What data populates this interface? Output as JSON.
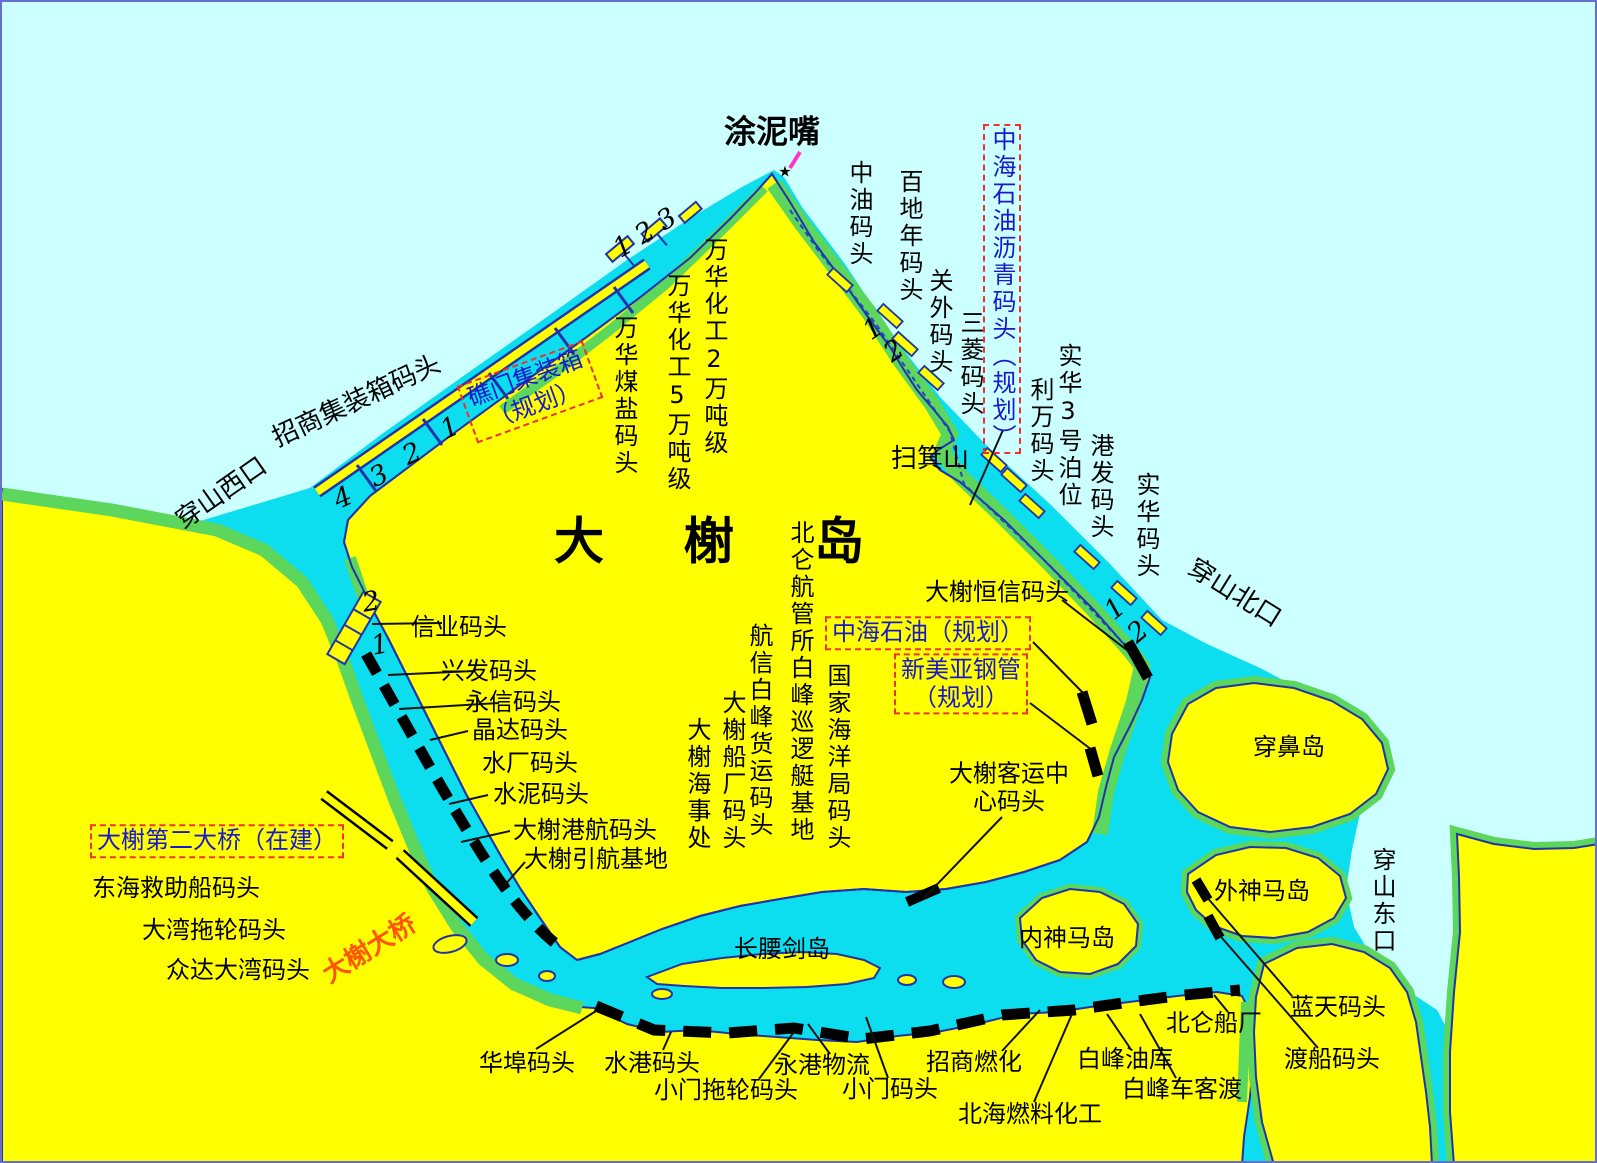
{
  "map": {
    "title": "大榭岛",
    "colors": {
      "sea_far": "#CCFFFF",
      "sea_channel": "#0CDEF0",
      "land": "#FFFF00",
      "coastal_green": "#5CD65C",
      "coast_outline": "#2233AA",
      "berth": "#000000",
      "planned_text": "#1818CC",
      "planned_box": "#F03030",
      "bridge_red_label": "#FF5500",
      "marker": "#FF33CC",
      "frame": "#6670CC"
    },
    "labels": [
      {
        "n": "tunizui",
        "t": "涂泥嘴",
        "x": 770,
        "y": 130,
        "c": "big"
      },
      {
        "n": "tunizui-star",
        "t": "★",
        "x": 783,
        "y": 170,
        "s": 15
      },
      {
        "n": "saojishan",
        "t": "扫箕山",
        "x": 928,
        "y": 458,
        "c": "mid"
      },
      {
        "n": "daxie-title",
        "t": "大榭岛",
        "x": 552,
        "y": 540,
        "c": "title"
      },
      {
        "n": "hengxin",
        "t": "大榭恒信码头",
        "x": 995,
        "y": 591
      },
      {
        "n": "xinye",
        "t": "信业码头",
        "x": 457,
        "y": 626
      },
      {
        "n": "xingfa",
        "t": "兴发码头",
        "x": 487,
        "y": 670
      },
      {
        "n": "yongxin",
        "t": "永信码头",
        "x": 511,
        "y": 701
      },
      {
        "n": "jingda",
        "t": "晶达码头",
        "x": 518,
        "y": 729
      },
      {
        "n": "shuichang",
        "t": "水厂码头",
        "x": 528,
        "y": 762
      },
      {
        "n": "shuini",
        "t": "水泥码头",
        "x": 539,
        "y": 793
      },
      {
        "n": "ganghang",
        "t": "大榭港航码头",
        "x": 583,
        "y": 829
      },
      {
        "n": "yinhang",
        "t": "大榭引航基地",
        "x": 594,
        "y": 858
      },
      {
        "n": "keyun",
        "t": "大榭客运中\n心码头",
        "x": 1007,
        "y": 786
      },
      {
        "n": "donghai",
        "t": "东海救助船码头",
        "x": 174,
        "y": 887
      },
      {
        "n": "dawan-tuolun",
        "t": "大湾拖轮码头",
        "x": 212,
        "y": 929
      },
      {
        "n": "zhongda",
        "t": "众达大湾码头",
        "x": 236,
        "y": 969
      },
      {
        "n": "changyaojian",
        "t": "长腰剑岛",
        "x": 780,
        "y": 948
      },
      {
        "n": "neishenma",
        "t": "内神马岛",
        "x": 1065,
        "y": 937
      },
      {
        "n": "chuanbidao",
        "t": "穿鼻岛",
        "x": 1287,
        "y": 746
      },
      {
        "n": "waishenma",
        "t": "外神马岛",
        "x": 1260,
        "y": 890
      },
      {
        "n": "lantian",
        "t": "蓝天码头",
        "x": 1336,
        "y": 1006
      },
      {
        "n": "duchuan",
        "t": "渡船码头",
        "x": 1330,
        "y": 1058
      },
      {
        "n": "beilun-chuanchang",
        "t": "北仑船厂",
        "x": 1212,
        "y": 1022
      },
      {
        "n": "huabu",
        "t": "华埠码头",
        "x": 525,
        "y": 1062
      },
      {
        "n": "shuigang",
        "t": "水港码头",
        "x": 650,
        "y": 1062
      },
      {
        "n": "xiaomen-tuolun",
        "t": "小门拖轮码头",
        "x": 724,
        "y": 1089
      },
      {
        "n": "yonggang-wuliu",
        "t": "永港物流",
        "x": 820,
        "y": 1064
      },
      {
        "n": "xiaomen",
        "t": "小门码头",
        "x": 888,
        "y": 1088
      },
      {
        "n": "zhaoshang-ranhua",
        "t": "招商燃化",
        "x": 972,
        "y": 1061
      },
      {
        "n": "beihai-ranliao",
        "t": "北海燃料化工",
        "x": 1028,
        "y": 1113
      },
      {
        "n": "baifeng-youku",
        "t": "白峰油库",
        "x": 1123,
        "y": 1058
      },
      {
        "n": "baifeng-chekedu",
        "t": "白峰车客渡",
        "x": 1180,
        "y": 1088
      },
      {
        "n": "zhonghai-shiyou",
        "t": "中海石油（规划）",
        "x": 926,
        "y": 631,
        "c": "plan boxed"
      },
      {
        "n": "xinmeiya",
        "t": "新美亚钢管\n（规划）",
        "x": 959,
        "y": 682,
        "c": "plan boxed"
      },
      {
        "n": "dier-daqiao",
        "t": "大榭第二大桥（在建）",
        "x": 215,
        "y": 839,
        "c": "plan boxed"
      },
      {
        "n": "daxie-daqiao",
        "t": "大榭大桥",
        "x": 368,
        "y": 948,
        "a": -32,
        "c": "red mid"
      },
      {
        "n": "chuanshan-xikou",
        "t": "穿山西口",
        "x": 220,
        "y": 492,
        "a": -35,
        "c": "mid"
      },
      {
        "n": "zhaoshang-jizhuangxiang",
        "t": "招商集装箱码头",
        "x": 355,
        "y": 400,
        "a": -25,
        "c": "mid"
      },
      {
        "n": "chuanshan-beikou",
        "t": "穿山北口",
        "x": 1232,
        "y": 592,
        "a": 32,
        "c": "mid"
      },
      {
        "n": "jiaomen",
        "t": "礁门集装箱\n（规划）",
        "x": 528,
        "y": 390,
        "a": -20,
        "c": "plan boxed"
      },
      {
        "n": "zhongyou",
        "t": "中油码头",
        "x": 857,
        "y": 158,
        "k": "v"
      },
      {
        "n": "baidinian",
        "t": "百地年码头",
        "x": 907,
        "y": 167,
        "k": "v"
      },
      {
        "n": "guanwai",
        "t": "关外码头",
        "x": 937,
        "y": 266,
        "k": "v"
      },
      {
        "n": "sanling",
        "t": "三菱码头",
        "x": 968,
        "y": 308,
        "k": "v"
      },
      {
        "n": "liwan",
        "t": "利万码头",
        "x": 1038,
        "y": 375,
        "k": "v"
      },
      {
        "n": "shihua3",
        "t": "实华3号泊位",
        "x": 1066,
        "y": 341,
        "k": "v"
      },
      {
        "n": "gangfa",
        "t": "港发码头",
        "x": 1098,
        "y": 431,
        "k": "v"
      },
      {
        "n": "shihua",
        "t": "实华码头",
        "x": 1144,
        "y": 470,
        "k": "v"
      },
      {
        "n": "wanhua2",
        "t": "万华化工2万吨级",
        "x": 712,
        "y": 235,
        "k": "v"
      },
      {
        "n": "wanhua5",
        "t": "万华化工5万吨级",
        "x": 675,
        "y": 271,
        "k": "v"
      },
      {
        "n": "wanhua-meiyan",
        "t": "万华煤盐码头",
        "x": 622,
        "y": 313,
        "k": "v"
      },
      {
        "n": "beilun-hangguan",
        "t": "北仑航管所白峰巡逻艇基地",
        "x": 798,
        "y": 518,
        "k": "v"
      },
      {
        "n": "hangxin-baifeng",
        "t": "航信白峰货运码头",
        "x": 757,
        "y": 621,
        "k": "v"
      },
      {
        "n": "daxie-chuanchang",
        "t": "大榭船厂码头",
        "x": 730,
        "y": 688,
        "k": "v"
      },
      {
        "n": "daxie-haishichu",
        "t": "大榭海事处",
        "x": 695,
        "y": 715,
        "k": "v"
      },
      {
        "n": "guojia-haiyangju",
        "t": "国家海洋局码头",
        "x": 835,
        "y": 661,
        "k": "v"
      },
      {
        "n": "chuanshan-dongkou",
        "t": "穿山东口",
        "x": 1380,
        "y": 845,
        "k": "v"
      },
      {
        "n": "zhonghai-liqing",
        "t": "中海石油沥青码头（规划）",
        "x": 1000,
        "y": 122,
        "k": "v",
        "c": "plan boxed"
      },
      {
        "n": "num-123",
        "t": "1 2 3",
        "x": 643,
        "y": 231,
        "a": -32,
        "c": "num"
      },
      {
        "n": "num-4",
        "t": "4",
        "x": 341,
        "y": 496,
        "a": -25,
        "c": "num"
      },
      {
        "n": "num-3",
        "t": "3",
        "x": 377,
        "y": 474,
        "a": -25,
        "c": "num"
      },
      {
        "n": "num-2a",
        "t": "2",
        "x": 410,
        "y": 452,
        "a": -25,
        "c": "num"
      },
      {
        "n": "num-1a",
        "t": "1",
        "x": 448,
        "y": 426,
        "a": -25,
        "c": "num"
      },
      {
        "n": "num-1b",
        "t": "1",
        "x": 871,
        "y": 327,
        "a": -35,
        "c": "num"
      },
      {
        "n": "num-2b",
        "t": "2",
        "x": 892,
        "y": 349,
        "a": -35,
        "c": "num"
      },
      {
        "n": "num-2c",
        "t": "2",
        "x": 369,
        "y": 600,
        "a": -10,
        "c": "num"
      },
      {
        "n": "num-1c",
        "t": "1",
        "x": 378,
        "y": 643,
        "a": -10,
        "c": "num"
      },
      {
        "n": "num-1d",
        "t": "1",
        "x": 1113,
        "y": 607,
        "a": -40,
        "c": "num"
      },
      {
        "n": "num-2d",
        "t": "2",
        "x": 1136,
        "y": 630,
        "a": -40,
        "c": "num"
      }
    ]
  }
}
